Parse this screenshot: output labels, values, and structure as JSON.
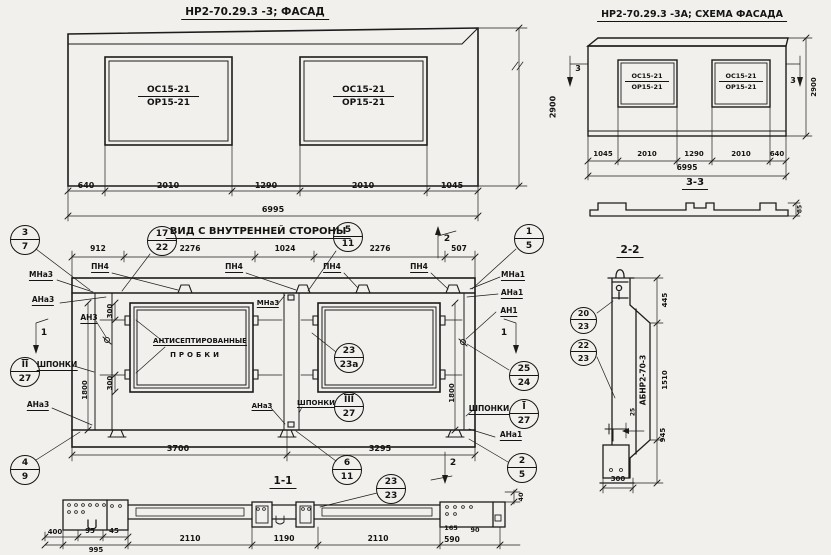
{
  "facade": {
    "title": "НР2-70.29.3 -3;  ФАСАД",
    "window": {
      "top": "ОС15-21",
      "bottom": "ОР15-21"
    },
    "dims": {
      "d1": "640",
      "d2": "2010",
      "d3": "1290",
      "d4": "2010",
      "d5": "1045",
      "total": "6995",
      "height": "2900"
    }
  },
  "scheme": {
    "title": "НР2-70.29.3 -3А; СХЕМА ФАСАДА",
    "window": {
      "top": "ОС15-21",
      "bottom": "ОР15-21"
    },
    "dims": {
      "d1": "1045",
      "d2": "2010",
      "d3": "1290",
      "d4": "2010",
      "d5": "640",
      "total": "6995",
      "height": "2900",
      "profile": "85"
    },
    "section_mark": "3",
    "section_label": "3-3"
  },
  "inner": {
    "title": "ВИД С ВНУТРЕННЕЙ СТОРОНЫ",
    "dims_top": {
      "d1": "912",
      "d2": "2276",
      "d3": "1024",
      "d4": "2276",
      "d5": "507"
    },
    "dims_bottom": {
      "d1": "3700",
      "d2": "3295"
    },
    "dim_1800": "1800",
    "dim_300": "300",
    "pn4": "ПН4",
    "labels": {
      "mna3": "МНа3",
      "ana3": "АНа3",
      "an3": "АН3",
      "mna1": "МНа1",
      "ana1": "АНа1",
      "an1": "АН1",
      "shponki": "ШПОНКИ",
      "plugs1": "АНТИСЕПТИРОВАННЫЕ",
      "plugs2": "ПРОБКИ"
    },
    "marks": {
      "m1": "1",
      "m2": "2"
    },
    "balloons": {
      "b37": {
        "t": "3",
        "b": "7"
      },
      "b1722": {
        "t": "17",
        "b": "22"
      },
      "b511": {
        "t": "5",
        "b": "11"
      },
      "b15": {
        "t": "1",
        "b": "5"
      },
      "b227": {
        "t": "II",
        "b": "27"
      },
      "b49": {
        "t": "4",
        "b": "9"
      },
      "b2323a": {
        "t": "23",
        "b": "23а"
      },
      "b327": {
        "t": "III",
        "b": "27"
      },
      "b2524": {
        "t": "25",
        "b": "24"
      },
      "b127": {
        "t": "I",
        "b": "27"
      },
      "b25": {
        "t": "2",
        "b": "5"
      },
      "b611": {
        "t": "6",
        "b": "11"
      }
    }
  },
  "section11": {
    "title": "1-1",
    "balloon": {
      "t": "23",
      "b": "23"
    },
    "dims": {
      "d400": "400",
      "d95": "95",
      "d45": "45",
      "d995": "995",
      "d2110a": "2110",
      "d1190": "1190",
      "d2110b": "2110",
      "d590": "590",
      "d165": "165",
      "d90": "90",
      "d40": "40"
    }
  },
  "section22": {
    "title": "2-2",
    "mark": "АБНР2-70-3",
    "balloon_top": {
      "t": "20",
      "b": "23"
    },
    "balloon_bottom": {
      "t": "22",
      "b": "23"
    },
    "dims": {
      "d445": "445",
      "d1510": "1510",
      "d25": "25",
      "d945": "945",
      "d300": "300"
    }
  }
}
